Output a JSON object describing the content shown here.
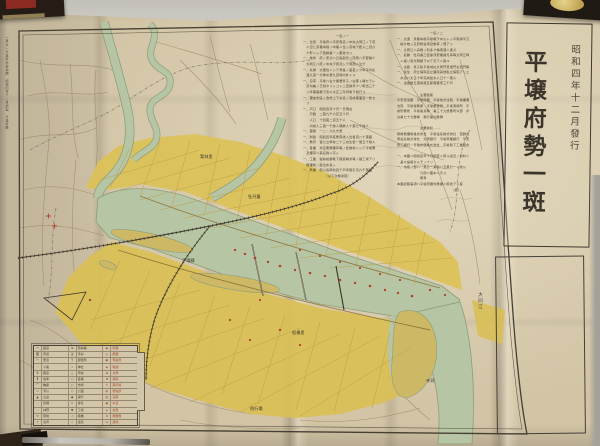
{
  "scene": {
    "wall_color": "#c9c5be",
    "paper_color": "#d2c4a5",
    "city_fill": "#dbc257",
    "river_fill": "#b6c5a3",
    "red_marks": "#b0432c",
    "ink": "#3f382e"
  },
  "title_panel": {
    "publish_date": "昭和四年十二月發行",
    "title": "平壌府勢一斑"
  },
  "margin_note": "一萬分一平壌府市街地圖　昭和四年十二月調製　平壌府廳",
  "river_label": "大同江",
  "map_labels": [
    {
      "text": "箕林里"
    },
    {
      "text": "牡丹臺"
    },
    {
      "text": "平壌驛"
    },
    {
      "text": "船橋里"
    },
    {
      "text": "飛行場"
    },
    {
      "text": "寺洞"
    }
  ],
  "text_columns": {
    "col_a": [
      "　　　　　　　　　　一班ノ一",
      "一、位置　平壌府ハ平安南道ノ中央大同江ノ下流",
      "　ニ沿ヒ京義本線ノ中樞ニ位シ京城ヲ距ル二百六",
      "　十粁ニシテ西鮮第一ノ都會タリ",
      "一、地勢　府ノ東北ハ丘陵起伏シ西南ハ平野開ケ",
      "　大同江ハ府ノ中央ヲ貫流シテ南西ニ注グ",
      "一、氣候　大陸性ニシテ寒暑ノ差甚シク年平均氣",
      "　温九度一分降水量九百粍内外トス",
      "一、沿革　平壌ハ古ク檀君箕子ノ古都ト稱セラレ",
      "　高句麗ノ王城タリシコト二百餘年ナリ明治三十",
      "　八年理事廳ヲ置キ大正三年府制ヲ施行ス",
      "一、爾來市區ノ改修上下水道ノ完成等面目一新セ",
      "　リ",
      "一、戸口　昭和四年十月一日現在",
      "　　戸數　二萬九千六百五十戸",
      "　　人口　十四萬二百五十人",
      "　　内地人三萬一千餘人朝鮮人十萬七千餘人",
      "一、面積　一二・六九方里",
      "一、財政　昭和四年度豫算歳入出各百八十萬圓",
      "一、教育　官公立學校二十三校生徒一萬五千餘人",
      "一、産業　米豆粟栗煙草等ノ集散地ニシテ平壌栗",
      "　及煙草ハ其名殊ニ高シ",
      "一、工業　製絲紡績靴下醸造精米等ノ諸工場アリ",
      "　無煙炭ノ産出亦多シ",
      "一、商業　卸小賣商約四千戸年取引高六千萬圓",
      "　　　　　　　（以下次欄參照）"
    ],
    "col_b": [
      "　　　　　　　　　　一班ノ二",
      "一、交通　京義本線平壌驛ヲ中心トシ平南線平元",
      "　線分岐シ又府營電車自動車ノ便アリ",
      "一、大同江ハ舟楫ノ利多ク鎮南浦ニ通ズ",
      "一、名勝　牡丹臺乙密臺浮碧樓練光亭等大同江畔",
      "　ニ連リ風光明媚ヲ以テ天下ニ聞ユ",
      "一、古蹟　箕子陵平壌城址大同門普通門玄武門等",
      "一、衞生　府立病院道立醫院其他私立病院アリ上",
      "　水道ハ大正十年完成給水人口十一萬人",
      "一、電燈數五萬餘燈瓦斯需要家三千戸",
      "",
      "　　　　　　　主要官衙",
      "平安南道廳　平壌府廳　平壌地方法院　平壌覆審",
      "法院　平壌税務署　平壌郵便局　平壌測候所　平",
      "壌刑務所　平壌憲兵隊　第三十九旅團司令部　步",
      "兵第七十七聯隊　飛行第六聯隊",
      "",
      "　　　　　　　主要會社",
      "朝鮮無煙炭株式會社　平壌電氣株式會社　西鮮合",
      "同電氣株式會社　大同銀行　平壌商業銀行　平安",
      "農工銀行　平壌倉庫株式會社　平壌靴下工業組合",
      "",
      "一、本圖ハ昭和四年十月調査ニ係ル最近ノ資料ニ",
      "　基キ編製セルモノナリ",
      "一、市街ノ部ハ一萬分一其他ハ五萬分一ニ依ル",
      "　　　　　　　凡例ハ圖中ニ示ス",
      "　　　　　　　備考",
      "本圖記載事項ハ平壌府廳内務課ニ照會アリ度",
      "　　　　　　　　　　　　　　　　　（終）"
    ]
  },
  "legend": {
    "rows": [
      {
        "s1": "━",
        "l1": "國道",
        "s2": "⊕",
        "l2": "警察署",
        "s3": "◉",
        "l3": "府廳"
      },
      {
        "s1": "〓",
        "l1": "府道",
        "s2": "卍",
        "l2": "寺刹",
        "s3": "◎",
        "l3": "郡廳"
      },
      {
        "s1": "╍",
        "l1": "里道",
        "s2": "〒",
        "l2": "郵便局",
        "s3": "▣",
        "l3": "專賣局"
      },
      {
        "s1": "┄",
        "l1": "小路",
        "s2": "☆",
        "l2": "神社",
        "s3": "⊞",
        "l3": "稅關"
      },
      {
        "s1": "┿",
        "l1": "鐵道",
        "s2": "△",
        "l2": "學校",
        "s3": "⊠",
        "l3": "兵營"
      },
      {
        "s1": "╂",
        "l1": "電車",
        "s2": "○",
        "l2": "官署",
        "s3": "✚",
        "l3": "病院"
      },
      {
        "s1": "⌒",
        "l1": "橋梁",
        "s2": "□",
        "l2": "市場",
        "s3": "✶",
        "l3": "飛行場"
      },
      {
        "s1": "≈",
        "l1": "河川",
        "s2": "◇",
        "l2": "公園",
        "s3": "▤",
        "l3": "發電所"
      },
      {
        "s1": "▲",
        "l1": "山岳",
        "s2": "◆",
        "l2": "銀行",
        "s3": "▥",
        "l3": "瓦斯"
      },
      {
        "s1": "∴",
        "l1": "田畑",
        "s2": "▽",
        "l2": "會社",
        "s3": "▦",
        "l3": "水道"
      },
      {
        "s1": "∵",
        "l1": "林野",
        "s2": "▼",
        "l2": "工場",
        "s3": "◈",
        "l3": "倉庫"
      },
      {
        "s1": "✕",
        "l1": "墓地",
        "s2": "◁",
        "l2": "棧橋",
        "s3": "⊗",
        "l3": "無煙炭"
      },
      {
        "s1": "†",
        "l1": "境界",
        "s2": "♨",
        "l2": "温泉",
        "s3": "⊟",
        "l3": "其他"
      }
    ]
  }
}
